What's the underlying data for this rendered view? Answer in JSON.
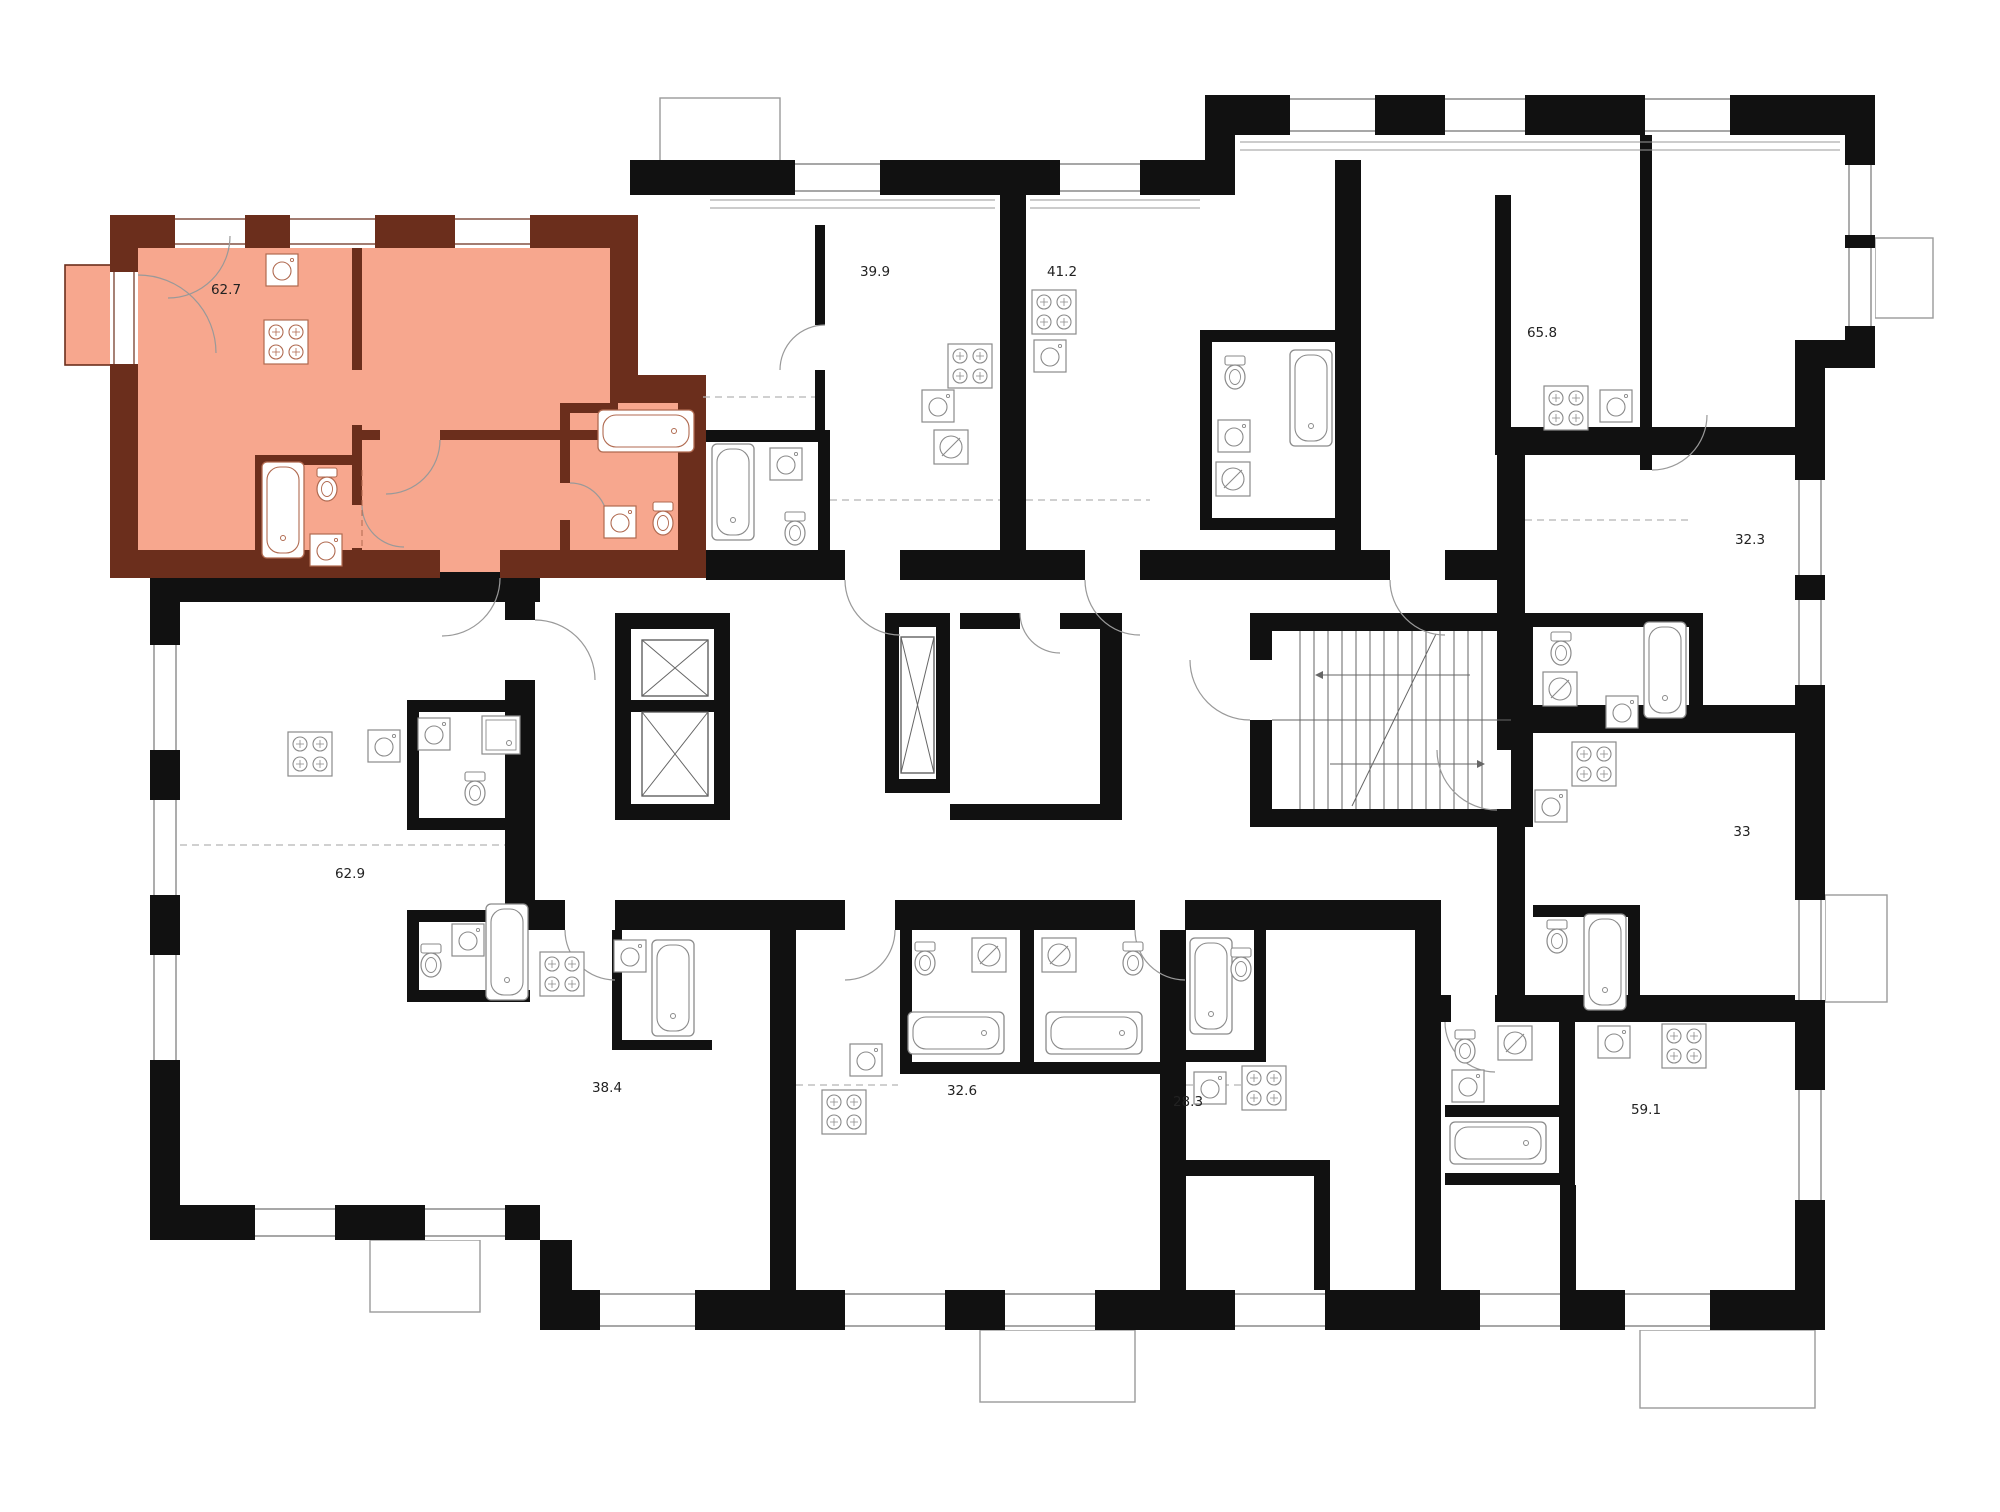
{
  "page": {
    "type": "residential-floor-plan",
    "description": "Multi-unit apartment storey plan with one selected apartment highlighted"
  },
  "colors": {
    "background": "#ffffff",
    "walls": "#111111",
    "selected_fill": "#f7a78e",
    "selected_walls": "#6b2e1c",
    "fixture_line": "#8a8a8a",
    "selected_fixture_line": "#b06a50",
    "door_arc": "#999999",
    "label_text": "#222222"
  },
  "selected_apartment": {
    "area": "62.7",
    "fill": "#f7a78e"
  },
  "apartments": [
    {
      "area": "62.7",
      "selected": true
    },
    {
      "area": "39.9",
      "selected": false
    },
    {
      "area": "41.2",
      "selected": false
    },
    {
      "area": "65.8",
      "selected": false
    },
    {
      "area": "32.3",
      "selected": false
    },
    {
      "area": "33",
      "selected": false
    },
    {
      "area": "62.9",
      "selected": false
    },
    {
      "area": "38.4",
      "selected": false
    },
    {
      "area": "32.6",
      "selected": false
    },
    {
      "area": "28.3",
      "selected": false
    },
    {
      "area": "59.1",
      "selected": false
    }
  ],
  "core": {
    "elevator_shafts": 3,
    "stairwells": 1
  },
  "icons": {
    "elevator": "rect-with-x-cross",
    "stairs": "tread-lines-with-direction-arrows",
    "bathtub": "rounded-tub-outline",
    "stove": "four-burner-rings",
    "kitchen-sink": "square-with-circle",
    "toilet": "oval-bowl-with-tank",
    "washer": "square-with-circle-and-slash",
    "shower": "square-with-inner-square"
  }
}
